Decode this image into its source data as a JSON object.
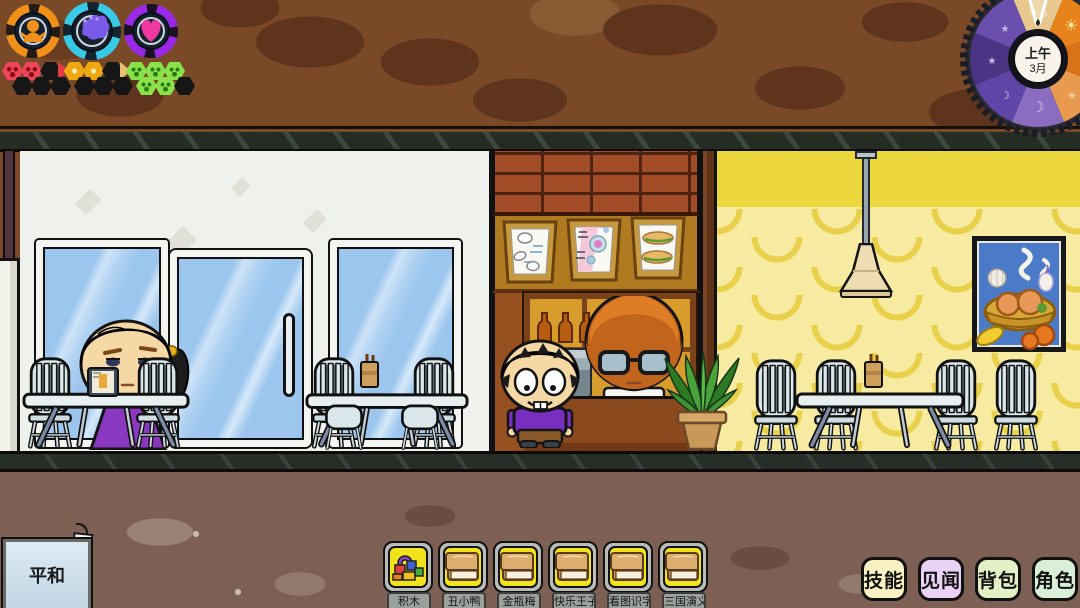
{
  "hud": {
    "gauges": [
      {
        "name": "vitality-gauge",
        "ring_color": "#f09018",
        "icon": "baby-icon"
      },
      {
        "name": "mind-gauge",
        "ring_color": "#38c8e8",
        "icon": "brain-icon"
      },
      {
        "name": "mood-gauge",
        "ring_color": "#9a28e8",
        "icon": "heart-icon"
      }
    ],
    "trait_trains": [
      {
        "name": "red-imp-train",
        "color": "#ee4656"
      },
      {
        "name": "gold-star-train",
        "color": "#e8b020"
      },
      {
        "name": "green-smile-train",
        "color": "#8ae24a"
      }
    ],
    "clock": {
      "period": "上午",
      "month": "3月"
    },
    "mood_sign": {
      "label": "平和"
    }
  },
  "hotbar": {
    "items": [
      {
        "label": "积木",
        "icon": "blocks-icon"
      },
      {
        "label": "丑小鸭",
        "icon": "book-icon"
      },
      {
        "label": "金瓶梅",
        "icon": "book-icon"
      },
      {
        "label": "快乐王子",
        "icon": "book-icon"
      },
      {
        "label": "看图识字",
        "icon": "book-icon"
      },
      {
        "label": "三国演义",
        "icon": "book-icon"
      }
    ]
  },
  "menu": {
    "buttons": [
      {
        "label": "技能",
        "bg": "#faf2c2"
      },
      {
        "label": "见闻",
        "bg": "#e9d2f6"
      },
      {
        "label": "背包",
        "bg": "#e3f0c5"
      },
      {
        "label": "角色",
        "bg": "#d9efd8"
      }
    ]
  },
  "scene": {
    "rooms": [
      "cafe-dining-white",
      "cafe-counter",
      "cafe-dining-yellow"
    ],
    "characters": [
      "girl-reading",
      "boy-customer",
      "barista-glasses"
    ]
  }
}
